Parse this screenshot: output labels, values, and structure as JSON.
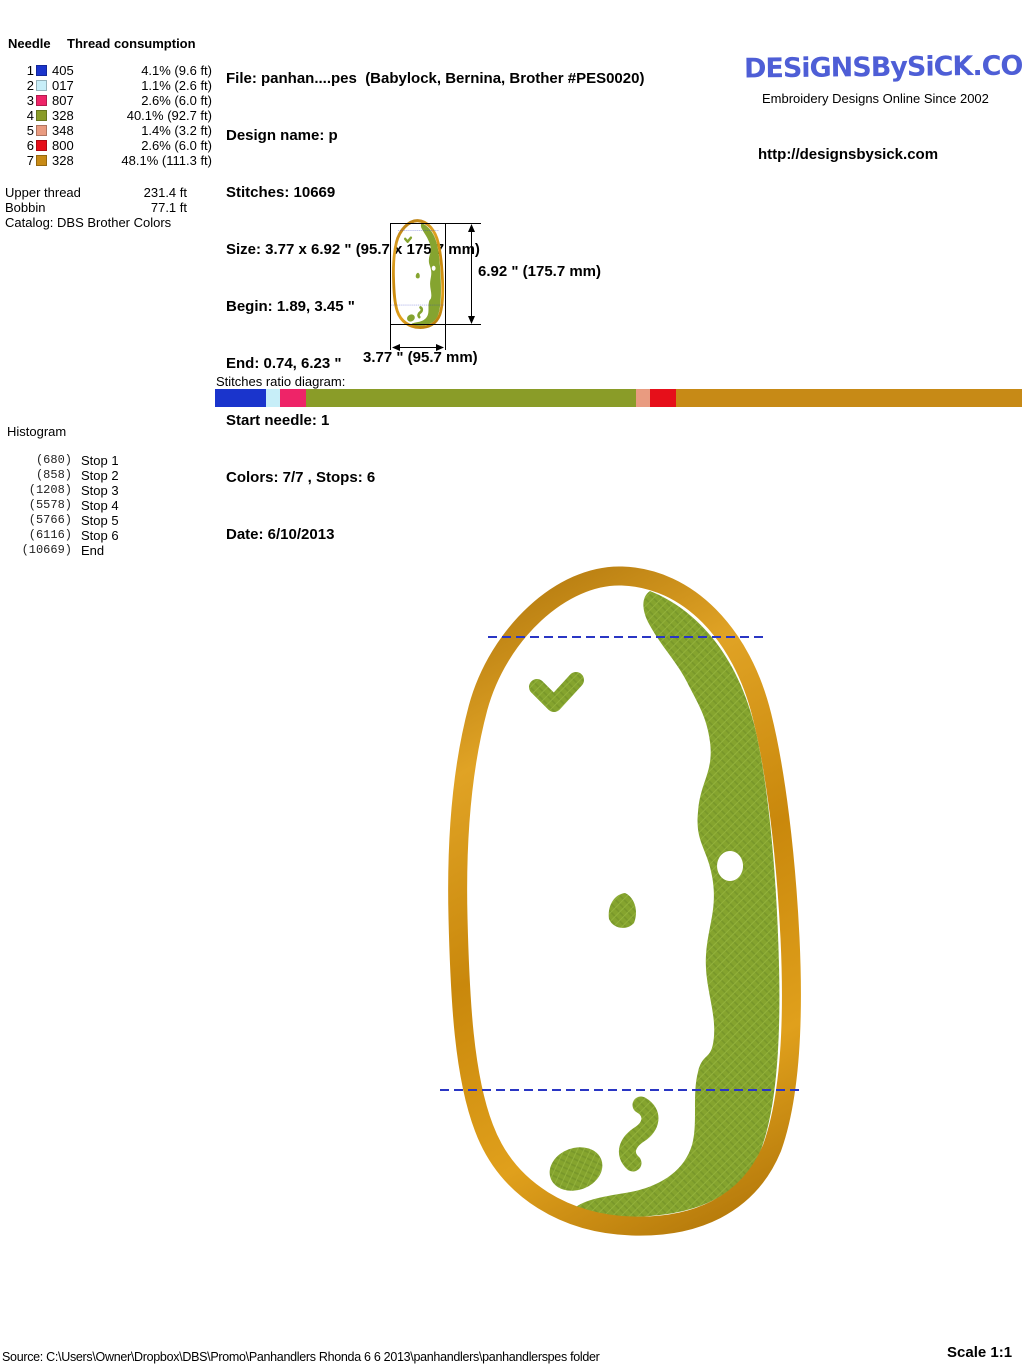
{
  "consumption_table": {
    "header_needle": "Needle",
    "header_thread": "Thread consumption",
    "rows": [
      {
        "needle": "1",
        "code": "405",
        "color": "#1a34cc",
        "consumption": "4.1% (9.6 ft)"
      },
      {
        "needle": "2",
        "code": "017",
        "color": "#c7eef8",
        "consumption": "1.1% (2.6 ft)"
      },
      {
        "needle": "3",
        "code": "807",
        "color": "#ee2468",
        "consumption": "2.6% (6.0 ft)"
      },
      {
        "needle": "4",
        "code": "328",
        "color": "#8a9c28",
        "consumption": "40.1% (92.7 ft)"
      },
      {
        "needle": "5",
        "code": "348",
        "color": "#e99b80",
        "consumption": "1.4% (3.2 ft)"
      },
      {
        "needle": "6",
        "code": "800",
        "color": "#e60f1a",
        "consumption": "2.6% (6.0 ft)"
      },
      {
        "needle": "7",
        "code": "328",
        "color": "#c78a16",
        "consumption": "48.1% (111.3 ft)"
      }
    ],
    "totals": [
      {
        "label": "Upper thread",
        "value": "231.4 ft"
      },
      {
        "label": "Bobbin",
        "value": "77.1 ft"
      }
    ],
    "catalog": "Catalog: DBS Brother Colors"
  },
  "file_info": {
    "file": "File: panhan....pes  (Babylock, Bernina, Brother #PES0020)",
    "design_name": "Design name: p",
    "stitches": "Stitches: 10669",
    "size": "Size: 3.77 x 6.92 \" (95.7 x 175.7 mm)",
    "begin": "Begin: 1.89, 3.45 \"",
    "end": "End: 0.74, 6.23 \"",
    "start_needle": "Start needle: 1",
    "colors": "Colors: 7/7 , Stops: 6",
    "date": "Date: 6/10/2013"
  },
  "branding": {
    "logo_text": "DESiGNSBySiCK.COM",
    "logo_color": "#4e5ed6",
    "tagline": "Embroidery Designs Online Since 2002",
    "url": "http://designsbysick.com"
  },
  "dimensions": {
    "height_label": "6.92 \" (175.7 mm)",
    "width_label": "3.77 \" (95.7 mm)"
  },
  "ratio_diagram": {
    "label": "Stitches ratio diagram:",
    "segments": [
      {
        "color": "#1a34cc",
        "width": 51
      },
      {
        "color": "#c7eef8",
        "width": 14
      },
      {
        "color": "#ee2468",
        "width": 26
      },
      {
        "color": "#8a9c28",
        "width": 330
      },
      {
        "color": "#e99b80",
        "width": 14
      },
      {
        "color": "#e60f1a",
        "width": 26
      },
      {
        "color": "#c78a16",
        "width": 346
      }
    ]
  },
  "histogram": {
    "title": "Histogram",
    "entries": [
      {
        "count": "(680)",
        "label": "Stop 1"
      },
      {
        "count": "(858)",
        "label": "Stop 2"
      },
      {
        "count": "(1208)",
        "label": "Stop 3"
      },
      {
        "count": "(5578)",
        "label": "Stop 4"
      },
      {
        "count": "(5766)",
        "label": "Stop 5"
      },
      {
        "count": "(6116)",
        "label": "Stop 6"
      },
      {
        "count": "(10669)",
        "label": "End"
      }
    ]
  },
  "design": {
    "border_color": "#cc8d0e",
    "fill_color": "#85a42e",
    "baste_color": "#2a36c4"
  },
  "footer": {
    "source": "Source: C:\\Users\\Owner\\Dropbox\\DBS\\Promo\\Panhandlers   Rhonda  6 6 2013\\panhandlers\\panhandlerspes folder",
    "scale": "Scale 1:1"
  }
}
